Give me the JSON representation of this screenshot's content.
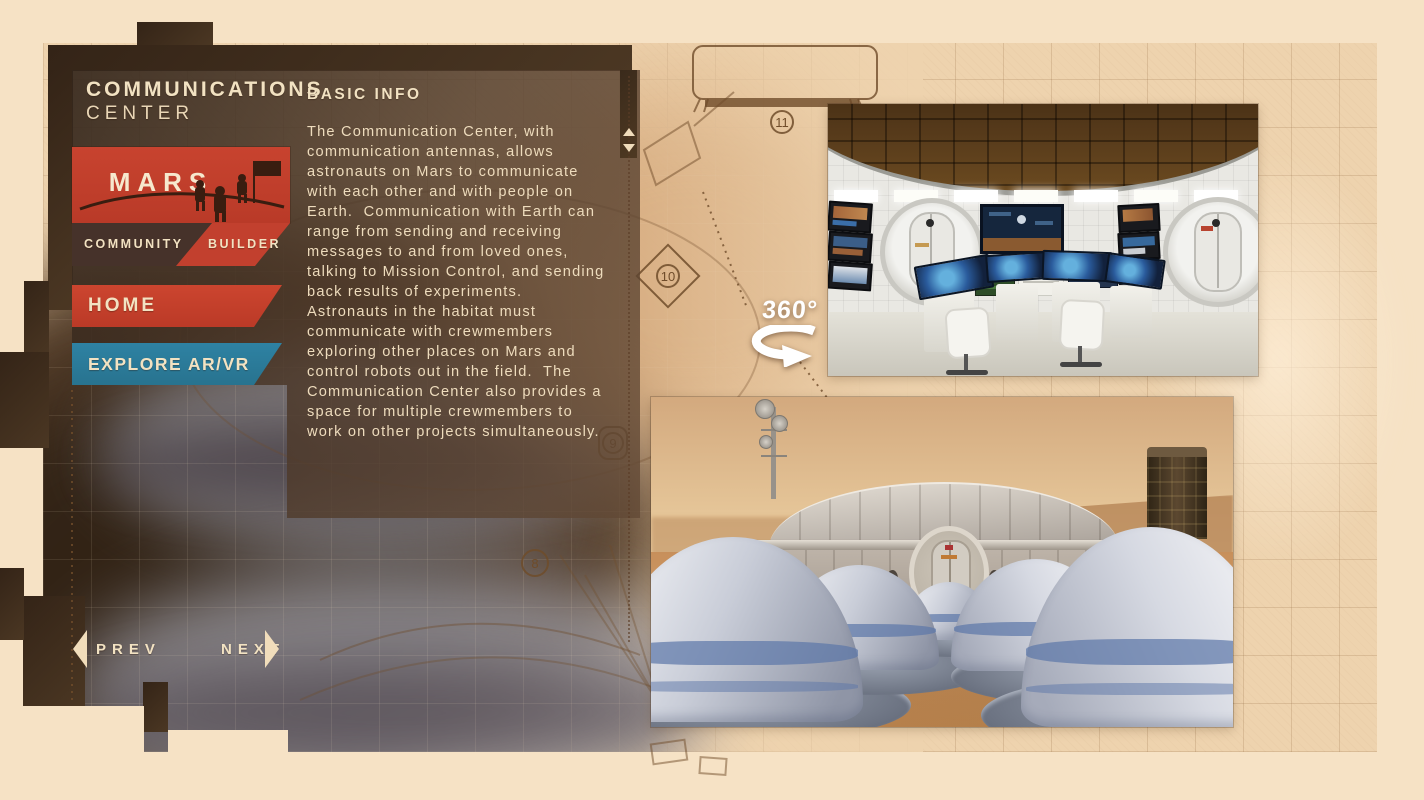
{
  "header": {
    "line1": "COMMUNICATIONS",
    "line2": "CENTER"
  },
  "logo": {
    "name": "MARS",
    "tag_left": "COMMUNITY",
    "tag_right": "BUILDER"
  },
  "nav": {
    "home": "HOME",
    "explore": "EXPLORE AR/VR"
  },
  "info": {
    "heading": "BASIC INFO",
    "body": "The Communication Center, with communication antennas, allows astronauts on Mars to communicate with each other and with people on Earth.  Communication with Earth can range from sending and receiving messages to and from loved ones, talking to Mission Control, and sending back results of experiments.  Astronauts in the habitat must communicate with crewmembers exploring other places on Mars and control robots out in the field.  The Communication Center also provides a space for multiple crewmembers to work on other projects simultaneously."
  },
  "pager": {
    "prev": "PREV",
    "next": "NEXT"
  },
  "viewer": {
    "badge": "360°"
  },
  "blueprint": {
    "callouts": [
      "8",
      "9",
      "10",
      "11"
    ]
  },
  "colors": {
    "accent_red": "#c2402e",
    "accent_teal": "#2b7d9e",
    "cream": "#f2e2c2",
    "panel_brown": "#5d4636",
    "dark_frame": "#3e2c1d",
    "paper": "#eed3ae",
    "outer": "#f6e2c5",
    "mars_ground": "#c78f5b"
  }
}
